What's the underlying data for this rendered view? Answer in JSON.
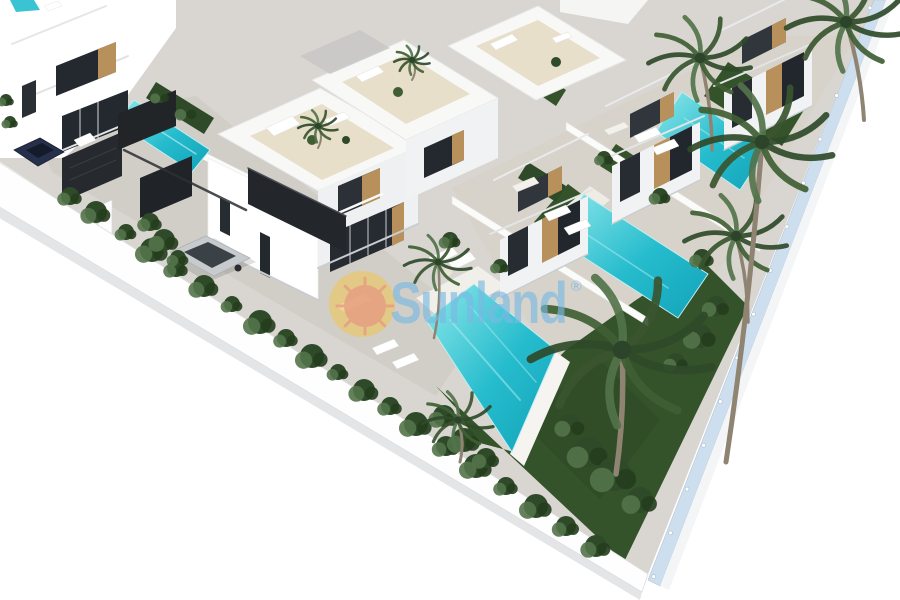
{
  "watermark": {
    "brand": "Sunland",
    "registered": "®"
  },
  "colors": {
    "background": "#ffffff",
    "pavement": "#d9d6d1",
    "street": "#cfccc5",
    "gravel": "#d7d2c7",
    "deck": "#f1efe9",
    "lawn": "#35532b",
    "lawn_dark": "#243d1d",
    "pool": "#25bccd",
    "pool_deep": "#13a2b8",
    "pool_light": "#8fe7ea",
    "wall_white": "#ffffff",
    "roof_slab": "#f8f8f7",
    "face_lit": "#f1f2f3",
    "face_shade": "#eef0f2",
    "solarium": "#e7dfca",
    "gravel_roof": "#c8c8c5",
    "window_dark": "#23292f",
    "wood": "#b8905c",
    "gate_dark": "#23262a",
    "glass_fence": "#c5d9ec",
    "fence_cap": "#f3f5f7",
    "car_silver": "#c8cbcd",
    "car_glass": "#3b4247",
    "car_navy": "#26304a",
    "bush": "#2f4a29",
    "bush_light": "#53734a",
    "frond_a": "#2f4a29",
    "frond_b": "#3f5e33",
    "frond_c": "#53734a",
    "palm_trunk": "#8f8372",
    "shadow_line": "#c9cdd0",
    "watermark_blue": "rgba(121,184,226,0.65)",
    "logo_yellow": "rgba(243,198,80,0.55)",
    "logo_sun": "rgba(230,152,128,0.75)"
  }
}
